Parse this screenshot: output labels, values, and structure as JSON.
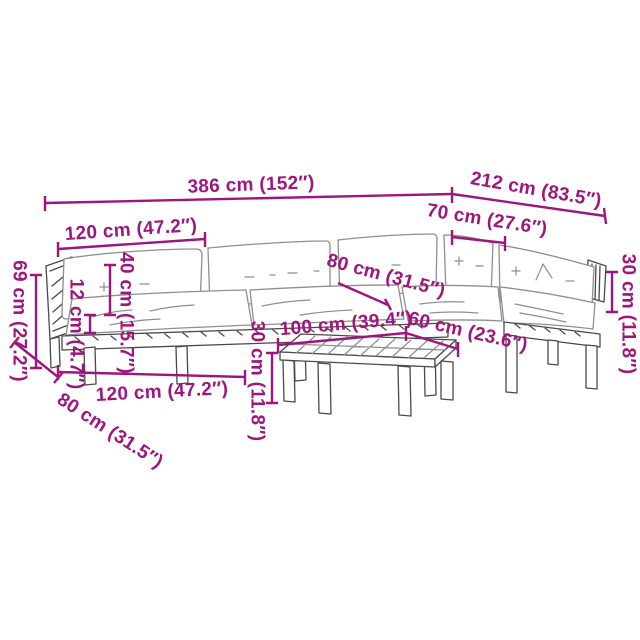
{
  "colors": {
    "dim": "#A0157D",
    "frame": "#4a4a4a",
    "soft": "#8f8f8f"
  },
  "dimensions": {
    "overall_width": "386 cm (152″)",
    "right_section_width": "212 cm (83.5″)",
    "module_width_back": "120 cm (47.2″)",
    "corner_module_width": "70 cm (27.6″)",
    "total_height": "69 cm (27.2″)",
    "armrest_above_seat": "12 cm (4.7″)",
    "backrest_height": "40 cm (15.7″)",
    "seat_depth": "80 cm (31.5″)",
    "back_cushion_height": "30 cm (11.8″)",
    "table_length": "100 cm (39.4″)",
    "table_depth": "60 cm (23.6″)",
    "table_height": "30 cm (11.8″)",
    "module_width_front": "120 cm (47.2″)",
    "sofa_depth": "80 cm (31.5″)"
  }
}
